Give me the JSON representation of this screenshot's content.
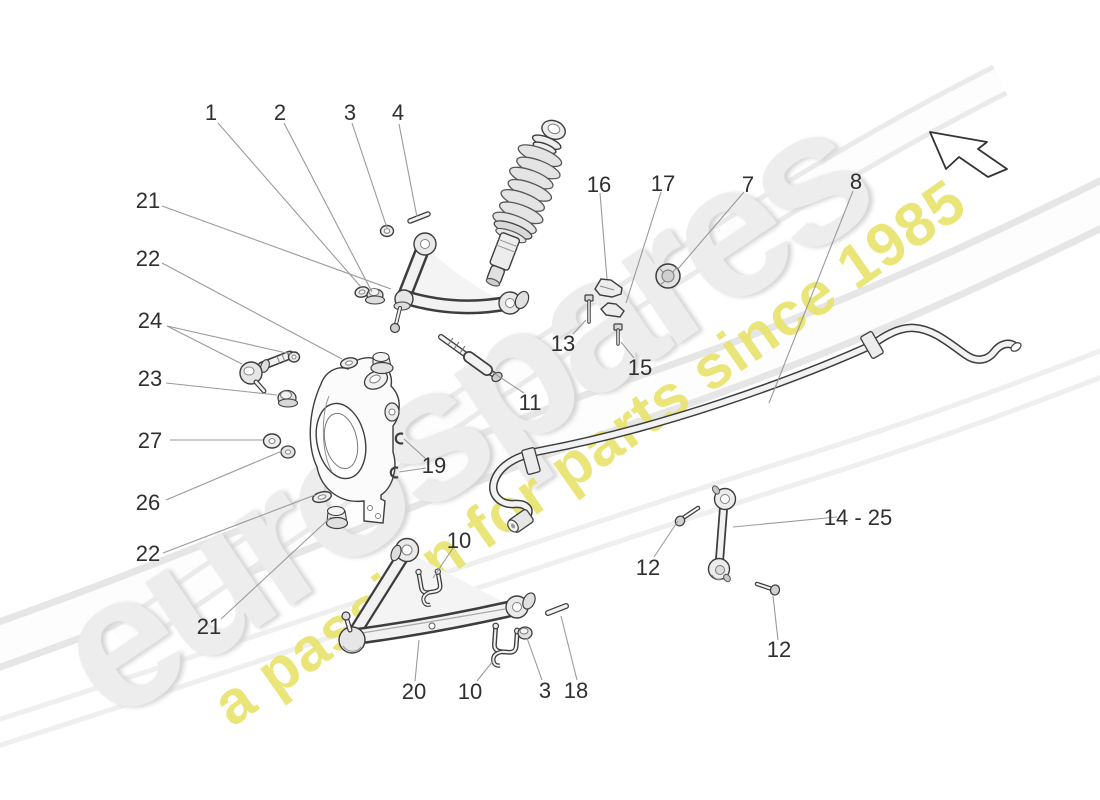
{
  "watermark": {
    "brand": "eurospares",
    "tagline": "a passion for parts since 1985"
  },
  "colors": {
    "outline": "#3d3d3d",
    "leader_line": "#9a9a9a",
    "label_text": "#2f2f2f",
    "watermark_gray": "#ededed",
    "watermark_yellow": "#e9e36e",
    "background": "#ffffff"
  },
  "callouts": [
    {
      "text": "1"
    },
    {
      "text": "2"
    },
    {
      "text": "3"
    },
    {
      "text": "4"
    },
    {
      "text": "21"
    },
    {
      "text": "22"
    },
    {
      "text": "24"
    },
    {
      "text": "23"
    },
    {
      "text": "27"
    },
    {
      "text": "26"
    },
    {
      "text": "22"
    },
    {
      "text": "21"
    },
    {
      "text": "16"
    },
    {
      "text": "17"
    },
    {
      "text": "7"
    },
    {
      "text": "8"
    },
    {
      "text": "13"
    },
    {
      "text": "15"
    },
    {
      "text": "11"
    },
    {
      "text": "19"
    },
    {
      "text": "10"
    },
    {
      "text": "12"
    },
    {
      "text": "14 - 25"
    },
    {
      "text": "12"
    },
    {
      "text": "20"
    },
    {
      "text": "10"
    },
    {
      "text": "3"
    },
    {
      "text": "18"
    }
  ]
}
